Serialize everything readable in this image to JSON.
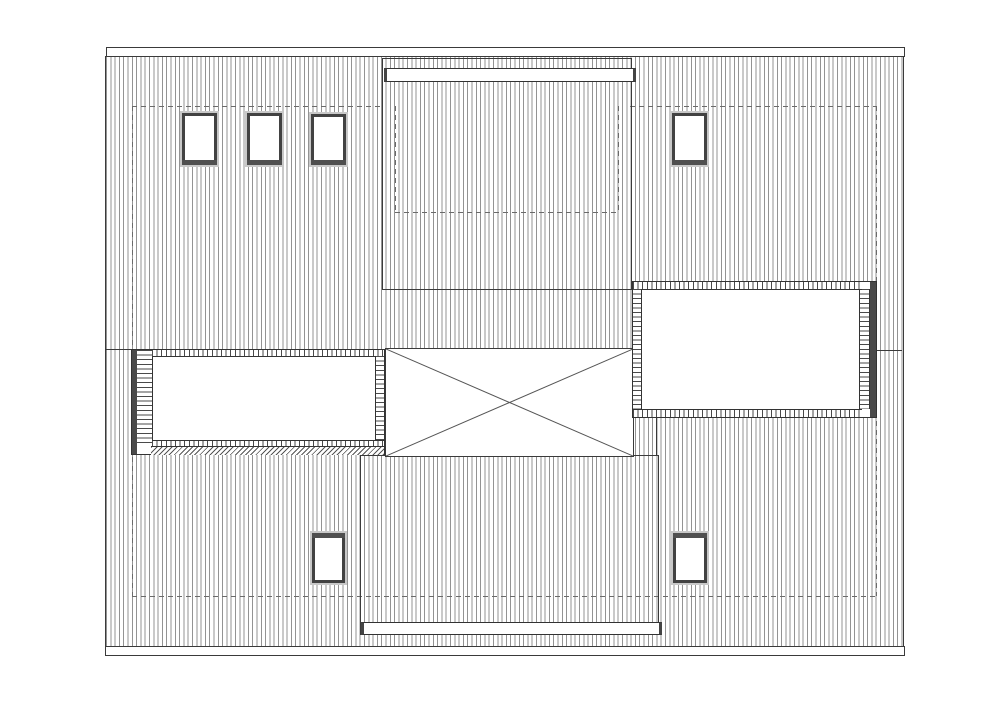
{
  "drawing": {
    "type": "architectural-roof-plan",
    "visible_text": "",
    "colors": {
      "background": "#ffffff",
      "line": "#3a3a3a",
      "hatch_line": "#8a8a8a",
      "dashed_line": "#6a6a6a",
      "frame_dark": "#4a4a4a",
      "frame_gray": "#c8c8c8"
    },
    "skylights": [
      {
        "x": 182,
        "y": 113,
        "w": 35,
        "h": 52,
        "band": "bottom"
      },
      {
        "x": 247,
        "y": 113,
        "w": 35,
        "h": 52,
        "band": "bottom"
      },
      {
        "x": 311,
        "y": 114,
        "w": 35,
        "h": 51,
        "band": "bottom"
      },
      {
        "x": 672,
        "y": 113,
        "w": 35,
        "h": 52,
        "band": "bottom"
      },
      {
        "x": 312,
        "y": 533,
        "w": 33,
        "h": 50,
        "band": "top"
      },
      {
        "x": 673,
        "y": 533,
        "w": 34,
        "h": 50,
        "band": "top"
      }
    ],
    "lines": [
      {
        "x1": 105,
        "y1": 349,
        "x2": 131,
        "y2": 349,
        "style": "solid",
        "name": "ridge-line-left"
      },
      {
        "x1": 877,
        "y1": 350,
        "x2": 902,
        "y2": 350,
        "style": "solid",
        "name": "ridge-line-right"
      },
      {
        "x1": 656,
        "y1": 418,
        "x2": 656,
        "y2": 455,
        "style": "solid",
        "name": "lower-box-right-edge-extension"
      },
      {
        "x1": 132,
        "y1": 106,
        "x2": 382,
        "y2": 106,
        "style": "dashed",
        "name": "wall-outline-top-left"
      },
      {
        "x1": 630,
        "y1": 106,
        "x2": 876,
        "y2": 106,
        "style": "dashed",
        "name": "wall-outline-top-right"
      },
      {
        "x1": 395,
        "y1": 106,
        "x2": 395,
        "y2": 212,
        "style": "dashed",
        "name": "wall-outline-jog-left"
      },
      {
        "x1": 618,
        "y1": 106,
        "x2": 618,
        "y2": 212,
        "style": "dashed",
        "name": "wall-outline-jog-right"
      },
      {
        "x1": 395,
        "y1": 212,
        "x2": 618,
        "y2": 212,
        "style": "dashed",
        "name": "wall-outline-jog-bottom"
      },
      {
        "x1": 132,
        "y1": 106,
        "x2": 132,
        "y2": 596,
        "style": "dashed",
        "name": "wall-outline-left"
      },
      {
        "x1": 876,
        "y1": 106,
        "x2": 876,
        "y2": 596,
        "style": "dashed",
        "name": "wall-outline-right"
      },
      {
        "x1": 132,
        "y1": 596,
        "x2": 876,
        "y2": 596,
        "style": "dashed",
        "name": "wall-outline-bottom"
      }
    ]
  }
}
